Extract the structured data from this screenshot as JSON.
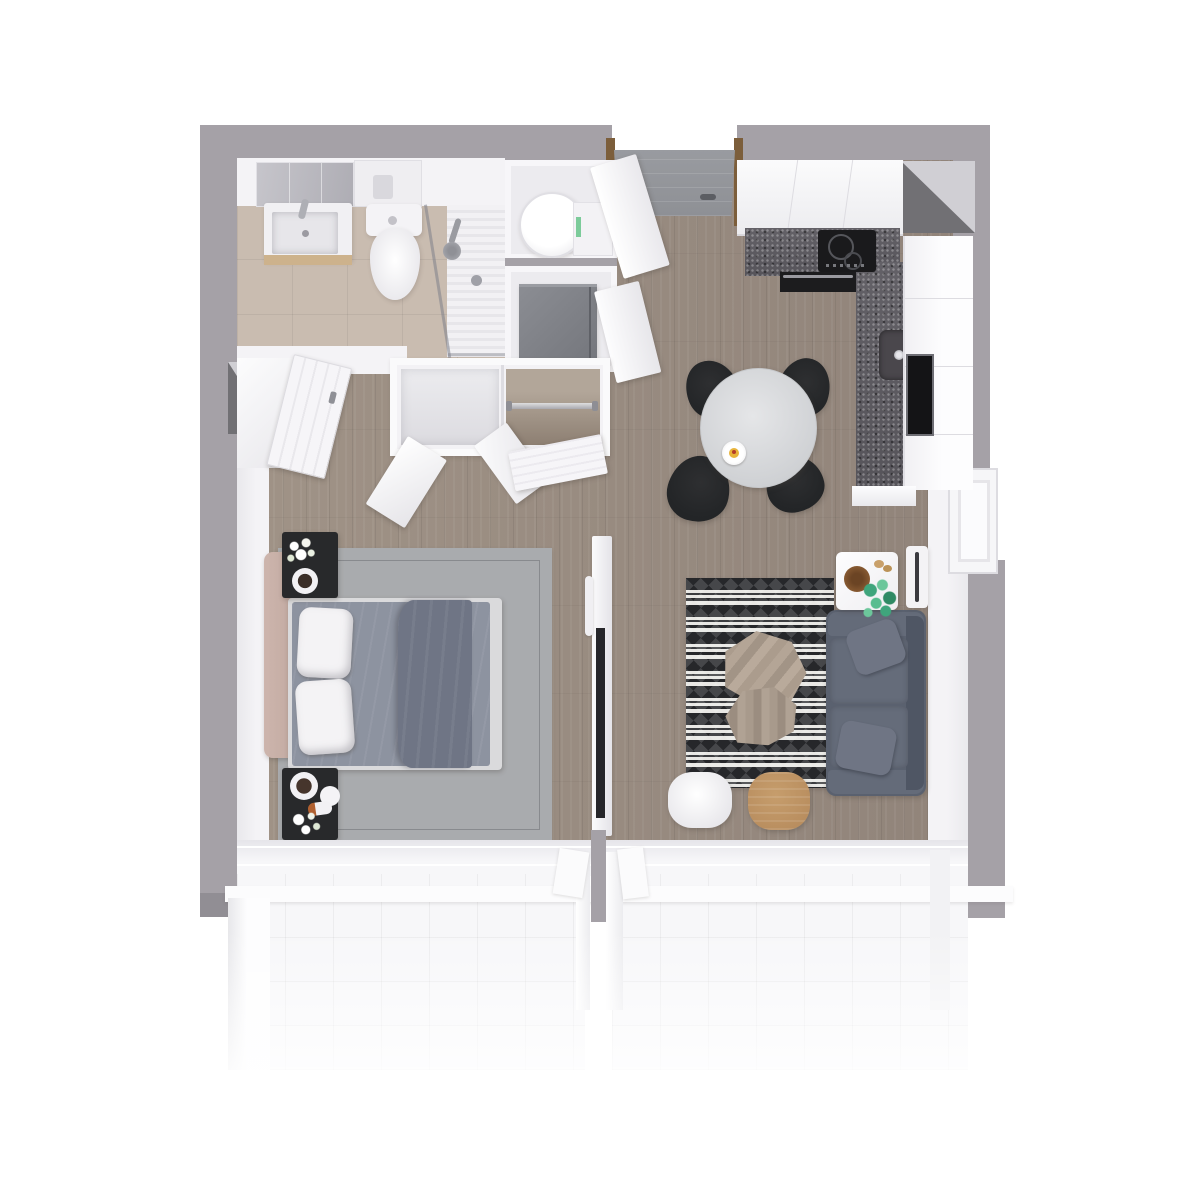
{
  "scene": {
    "kind": "top-down-3d-apartment-floor-plan-render",
    "background": "#ffffff"
  },
  "palette": {
    "wall": "#a5a1a7",
    "wall_dark": "#918e94",
    "interior_white": "#f4f3f6",
    "wood_floor": "#a09387",
    "wood_floor_dark": "#91847a",
    "tile_beige": "#c9bcb0",
    "balcony_tile": "#f7f7f9",
    "door_gray": "#8e9095",
    "door_frame_wood": "#7c5e3b",
    "counter_dark": "#5e5b60",
    "appliance_black": "#1a1a1c",
    "fridge_gray": "#7f8187",
    "table_light": "#d8d9db",
    "chair_black": "#232527",
    "sofa_slate": "#5a616f",
    "sofa_cushion": "#656c7a",
    "rug_living_dark": "#26272a",
    "rug_living_light": "#e8e7e4",
    "rug_bedroom": "#a9abae",
    "bed_sheet": "#8d93a0",
    "bed_blanket": "#6f7585",
    "pillow_white": "#f4f3f5",
    "headboard_blush": "#c3aba2",
    "nightstand_black": "#28292b",
    "stool_wood": "#b98e5f",
    "plant_green": "#46a87e",
    "bowl_wood": "#8a5c33",
    "chrome": "#aeafb5",
    "cup_yellow": "#e8b33a"
  },
  "rooms": [
    {
      "name": "bathroom",
      "items": [
        "vanity-sink",
        "mirror",
        "toilet",
        "shower",
        "bathroom-door",
        "window"
      ]
    },
    {
      "name": "hallway-entry",
      "items": [
        "entry-door",
        "washing-machine-closet",
        "fridge-closet",
        "wardrobe-open-doors"
      ]
    },
    {
      "name": "kitchen",
      "items": [
        "upper-cabinets",
        "dark-countertop",
        "cooktop",
        "oven",
        "sink",
        "tall-cabinets",
        "window"
      ]
    },
    {
      "name": "dining-area",
      "items": [
        "round-table",
        "black-chair",
        "black-chair",
        "black-chair",
        "black-chair",
        "coffee-cup"
      ]
    },
    {
      "name": "bedroom",
      "items": [
        "double-bed",
        "gray-rug",
        "nightstand-flowers",
        "nightstand-tray",
        "headboard",
        "window"
      ]
    },
    {
      "name": "living-room",
      "items": [
        "sofa",
        "patterned-rug",
        "coffee-table",
        "coffee-table",
        "side-table-plant",
        "radiator",
        "white-stool",
        "wood-stool",
        "tv-partition",
        "window"
      ]
    },
    {
      "name": "balcony-left",
      "items": [
        "glass-balustrade",
        "white-tile-floor"
      ]
    },
    {
      "name": "balcony-right",
      "items": [
        "glass-balustrade",
        "white-tile-floor"
      ]
    }
  ]
}
